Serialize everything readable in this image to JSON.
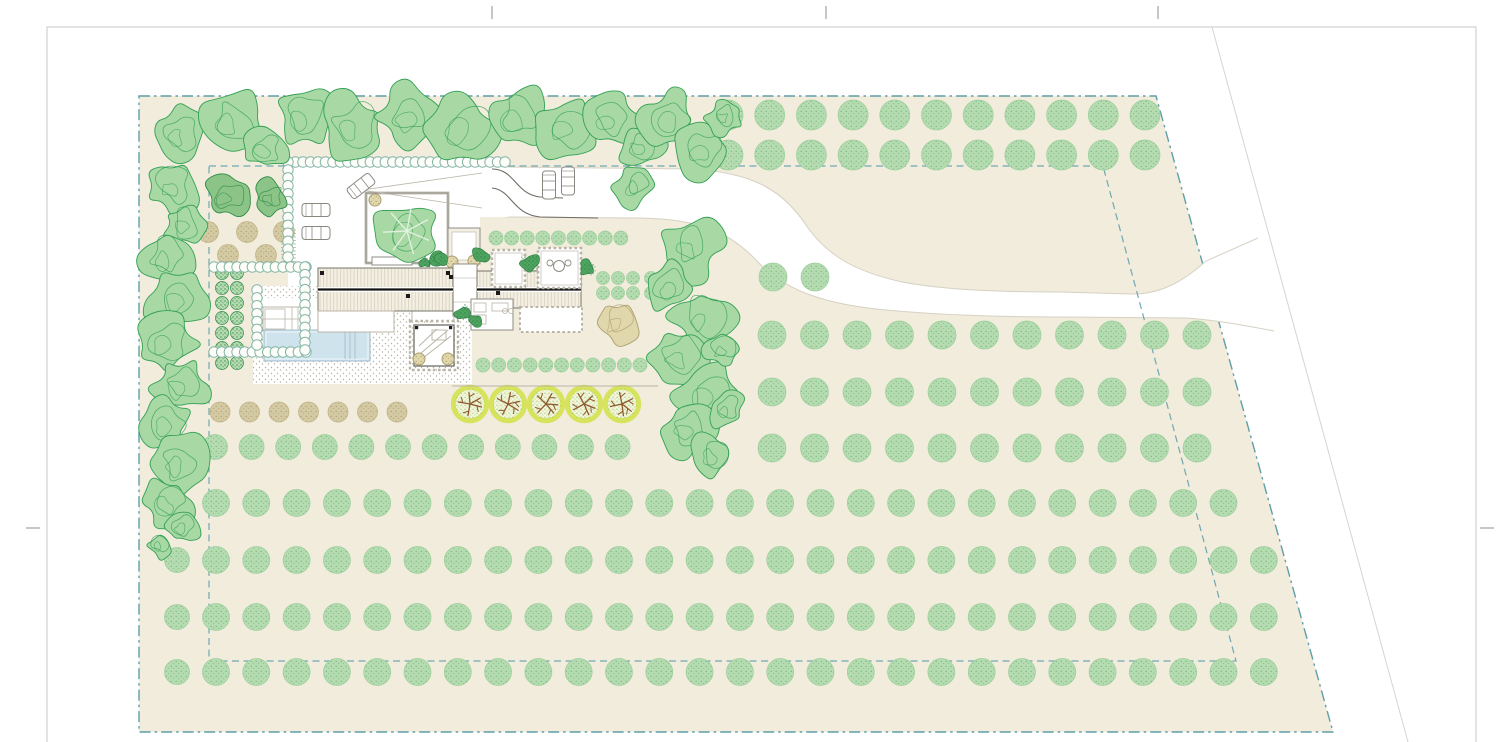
{
  "meta": {
    "drawing": "residential-site-plan",
    "width": 1500,
    "height": 742
  },
  "palette": {
    "paper": "#ffffff",
    "frame": "#c9c9c9",
    "crop": "#8c8c8c",
    "diag_road": "#d4d4d4",
    "site_fill": "#f1ecdc",
    "boundary": "#5f9fa8",
    "inner_boundary": "#6fa8b2",
    "road_edge": "#d6d1c3",
    "compound_fill": "#ffffff",
    "orchard_fill": "#b5dbb0",
    "orchard_stroke": "#9ccf9b",
    "orchard_speck": "#63a96f",
    "tan_fill": "#d3c9a2",
    "tan_stroke": "#c0b186",
    "tan_speck": "#a3905f",
    "hatch_fill": "#a8d8a4",
    "hatch_stroke": "#33a055",
    "dark_fill": "#8cc487",
    "dark_stroke": "#2d8c49",
    "clump_fill": "#4ea45f",
    "clump_stroke": "#2e7d43",
    "chain_stroke": "#84b5a6",
    "chain_fill": "#fdfdf9",
    "yellow_ring": "#d7e35c",
    "yellow_fill": "#f3f5d9",
    "yellow_speck": "#86b86a",
    "branch": "#8f5a2e",
    "olive_fill": "#e0d7ad",
    "olive_stroke": "#ac9e6e",
    "pool_fill": "#cfe3ed",
    "pool_edge": "#a6bccb",
    "roof_fill": "#f3efe3",
    "roof_stripe": "#dcd5c3",
    "roof_edge": "#77746a",
    "ridge": "#141414",
    "wall_light": "#c6c3b9",
    "wall_dark": "#8f8c83",
    "detail": "#b9b4a6",
    "gravel_dot": "#b5b0a2",
    "car_stroke": "#8a877f"
  },
  "page": {
    "frame": [
      47,
      27,
      1429,
      745
    ],
    "crop_top_xs": [
      492,
      826,
      1158
    ],
    "crop_top_y": [
      6,
      19
    ],
    "crop_side_y": 528,
    "crop_left_x": [
      26,
      40
    ],
    "crop_right_x": [
      1480,
      1494
    ],
    "diag_road_line": [
      1212,
      27,
      1408,
      742
    ]
  },
  "site": {
    "outer": [
      [
        139,
        96
      ],
      [
        1156,
        96
      ],
      [
        1333,
        732
      ],
      [
        139,
        732
      ]
    ],
    "inner": [
      [
        209,
        166
      ],
      [
        1103,
        166
      ],
      [
        1236,
        661
      ],
      [
        209,
        661
      ]
    ],
    "outer_dash": "11 4 2.5 4",
    "inner_dash": "7 4.5"
  },
  "road": {
    "outline": "M505,167 L690,169 C755,172 785,192 808,228 C830,258 858,272 902,282 C945,290 1000,292 1060,292 L1130,294 C1162,295 1186,279 1206,261 L1258,238 L1274,331 C1242,325 1216,320 1186,318 L1060,317 C1000,317 940,315 886,310 C830,305 786,292 758,262 C730,232 700,219 640,218 L505,217 Z",
    "upper": "M505,167 L690,169 C755,172 785,192 808,228 C830,258 858,272 902,282 C945,290 1000,292 1060,292 L1130,294 C1162,295 1186,279 1206,261 L1258,238",
    "lower": "M505,217 L640,218 C700,219 730,232 758,262 C786,292 830,305 886,310 C940,315 1000,317 1060,317 L1186,318 C1216,320 1242,325 1274,331"
  },
  "compound": {
    "poly": [
      [
        288,
        161
      ],
      [
        508,
        161
      ],
      [
        508,
        217
      ],
      [
        480,
        217
      ],
      [
        480,
        268
      ],
      [
        370,
        268
      ],
      [
        370,
        290
      ],
      [
        288,
        290
      ]
    ]
  },
  "stair": {
    "rect": [
      281,
      230,
      15,
      32
    ],
    "step": 3.5
  },
  "gravel_terrace": {
    "rect": [
      253,
      286,
      219,
      98
    ],
    "white_zone": [
      258,
      298,
      118,
      38
    ]
  },
  "pergola": {
    "outer": [
      263,
      307,
      39,
      24
    ],
    "inner_left": [
      265,
      309,
      20,
      20
    ],
    "vlines": [
      292,
      298
    ],
    "hline": 319
  },
  "pool": {
    "rect": [
      264,
      330,
      106,
      31
    ],
    "steps": [
      345,
      350,
      355
    ]
  },
  "chairs": {
    "positions": [
      [
        339,
        311
      ],
      [
        348,
        311
      ],
      [
        357,
        311
      ]
    ],
    "w": 7,
    "h": 13
  },
  "pavilion": {
    "patio": [
      412,
      307,
      42,
      16
    ],
    "room": [
      414,
      325,
      40,
      41
    ],
    "olives": [
      [
        419,
        359
      ],
      [
        448,
        359
      ]
    ],
    "squares": [
      [
        415,
        326
      ],
      [
        449,
        326
      ]
    ],
    "diagonals": [
      [
        420,
        354,
        448,
        330
      ],
      [
        423,
        358,
        451,
        336
      ],
      [
        419,
        346,
        437,
        329
      ]
    ],
    "mini_rect": [
      432,
      330,
      14,
      10
    ]
  },
  "courtyard": {
    "rect": [
      366,
      193,
      82,
      70
    ],
    "planter": [
      372,
      257,
      40,
      8
    ],
    "tree": {
      "c": [
        407,
        231
      ],
      "r": 30,
      "seed": 101
    },
    "corner_olive": [
      375,
      200,
      6
    ]
  },
  "vestibule": {
    "rect": [
      448,
      228,
      32,
      36
    ],
    "olives": [
      [
        452,
        262
      ],
      [
        474,
        261
      ]
    ]
  },
  "connector": {
    "rect": [
      453,
      264,
      24,
      52
    ]
  },
  "wings": {
    "left": [
      318,
      268,
      135,
      43
    ],
    "right": [
      477,
      271,
      104,
      37
    ],
    "ridge_y": 289.5,
    "vents": [
      [
        320,
        271
      ],
      [
        446,
        271
      ],
      [
        406,
        294
      ],
      [
        496,
        291
      ],
      [
        449,
        275
      ]
    ]
  },
  "south_rooms": {
    "kitchen": [
      471,
      299,
      42,
      31
    ],
    "fixture_rects": [
      [
        474,
        303,
        12,
        9
      ],
      [
        474,
        315,
        12,
        9
      ],
      [
        492,
        303,
        16,
        8
      ]
    ],
    "fixture_circles": [
      [
        505,
        311
      ],
      [
        511,
        311
      ]
    ],
    "patio": [
      520,
      307,
      62,
      25
    ],
    "left_room": [
      318,
      311,
      76,
      21
    ]
  },
  "north_rooms": {
    "room_a": [
      492,
      250,
      33,
      37
    ],
    "room_b": [
      538,
      248,
      43,
      40
    ],
    "table": {
      "c": [
        559,
        266
      ],
      "r": 5.5,
      "sides": [
        [
          550,
          263
        ],
        [
          568,
          263
        ]
      ]
    }
  },
  "clumps": [
    [
      481,
      256,
      9
    ],
    [
      530,
      263,
      10
    ],
    [
      588,
      268,
      8
    ],
    [
      463,
      313,
      8
    ],
    [
      436,
      258,
      7
    ],
    [
      425,
      262,
      6
    ],
    [
      442,
      260,
      6
    ],
    [
      475,
      321,
      6
    ]
  ],
  "sight_lines": [
    [
      362,
      190,
      482,
      173
    ],
    [
      362,
      190,
      482,
      208
    ]
  ],
  "drive_curves": [
    "M492,169 C515,169 515,194 540,197 L563,198",
    "M492,188 C512,190 512,214 540,217 L598,218"
  ],
  "cars": [
    [
      316,
      210,
      0
    ],
    [
      316,
      233,
      0
    ],
    [
      361,
      186,
      -38
    ],
    [
      549,
      185,
      90
    ],
    [
      568,
      181,
      90
    ]
  ],
  "orchard": {
    "rows": [
      {
        "y": 115,
        "x0": 728,
        "dx": 41.7,
        "n": 11,
        "d": 30
      },
      {
        "y": 155,
        "x0": 728,
        "dx": 41.7,
        "n": 11,
        "d": 30
      },
      {
        "y": 335,
        "x0": 772,
        "dx": 42.5,
        "n": 11,
        "d": 28
      },
      {
        "y": 392,
        "x0": 772,
        "dx": 42.5,
        "n": 11,
        "d": 28
      },
      {
        "y": 448,
        "x0": 772,
        "dx": 42.5,
        "n": 11,
        "d": 28
      },
      {
        "y": 447,
        "x0": 215,
        "dx": 36.6,
        "n": 12,
        "d": 25
      },
      {
        "y": 503,
        "x0": 216,
        "dx": 40.3,
        "n": 26,
        "d": 27
      },
      {
        "y": 560,
        "x0": 216,
        "dx": 40.3,
        "n": 27,
        "d": 27
      },
      {
        "y": 617,
        "x0": 216,
        "dx": 40.3,
        "n": 27,
        "d": 27
      },
      {
        "y": 672,
        "x0": 216,
        "dx": 40.3,
        "n": 27,
        "d": 27
      }
    ],
    "singles": [
      [
        773,
        277,
        28
      ],
      [
        815,
        277,
        28
      ],
      [
        177,
        560,
        25
      ],
      [
        177,
        617,
        25
      ],
      [
        177,
        672,
        25
      ]
    ]
  },
  "tan_row": {
    "y": 412,
    "x0": 220,
    "dx": 29.5,
    "n": 7,
    "d": 20
  },
  "tan_bed": {
    "d": 21,
    "positions": [
      [
        208,
        232
      ],
      [
        247,
        232
      ],
      [
        284,
        232
      ],
      [
        228,
        255
      ],
      [
        266,
        255
      ]
    ]
  },
  "kitchen_garden": {
    "cols": [
      222,
      237
    ],
    "y0": 273,
    "dy": 15,
    "n": 7,
    "d": 13
  },
  "hedge_rows": [
    {
      "y": 238,
      "x0": 496,
      "dx": 15.6,
      "n": 9,
      "d": 14
    },
    {
      "y": 365,
      "x0": 483,
      "dx": 15.7,
      "n": 11,
      "d": 14
    }
  ],
  "hedge_grids": [
    {
      "x0": 603,
      "dx": 15,
      "n": 3,
      "rows": [
        278,
        293
      ],
      "d": 13
    },
    {
      "x0": 651,
      "dx": 15,
      "n": 3,
      "rows": [
        278,
        293
      ],
      "d": 13
    }
  ],
  "chains": [
    [
      288,
      162,
      505,
      162
    ],
    [
      288,
      162,
      288,
      257
    ],
    [
      214,
      267,
      306,
      267
    ],
    [
      214,
      352,
      306,
      352
    ],
    [
      305,
      267,
      305,
      350
    ],
    [
      257,
      290,
      257,
      345
    ]
  ],
  "yellow_trees": {
    "cy": 404,
    "r": 19,
    "xs": [
      470,
      508,
      546,
      584,
      622
    ]
  },
  "terrace_line": [
    452,
    386,
    658,
    386
  ],
  "olive_tree": [
    617,
    323,
    21,
    55
  ],
  "dark_pair": [
    [
      227,
      197,
      21,
      31
    ],
    [
      270,
      197,
      17,
      32
    ]
  ],
  "canopies": [
    [
      178,
      133,
      26,
      1
    ],
    [
      232,
      122,
      30,
      2
    ],
    [
      265,
      150,
      20,
      3
    ],
    [
      305,
      116,
      30,
      4
    ],
    [
      352,
      128,
      33,
      5
    ],
    [
      408,
      117,
      30,
      6
    ],
    [
      462,
      127,
      33,
      7
    ],
    [
      518,
      117,
      30,
      8
    ],
    [
      566,
      129,
      28,
      9
    ],
    [
      610,
      118,
      26,
      10
    ],
    [
      641,
      147,
      22,
      11
    ],
    [
      635,
      186,
      20,
      12
    ],
    [
      670,
      120,
      28,
      13
    ],
    [
      703,
      149,
      26,
      14
    ],
    [
      725,
      117,
      18,
      15
    ],
    [
      172,
      186,
      26,
      16
    ],
    [
      184,
      224,
      20,
      17
    ],
    [
      166,
      257,
      26,
      18
    ],
    [
      178,
      300,
      30,
      19
    ],
    [
      167,
      344,
      28,
      20
    ],
    [
      180,
      387,
      26,
      21
    ],
    [
      166,
      424,
      24,
      22
    ],
    [
      179,
      463,
      28,
      23
    ],
    [
      168,
      503,
      24,
      24
    ],
    [
      182,
      527,
      17,
      25
    ],
    [
      160,
      545,
      13,
      26
    ],
    [
      690,
      247,
      30,
      27
    ],
    [
      670,
      288,
      25,
      28
    ],
    [
      702,
      318,
      30,
      29
    ],
    [
      680,
      357,
      28,
      30
    ],
    [
      706,
      394,
      30,
      31
    ],
    [
      688,
      429,
      25,
      32
    ],
    [
      712,
      455,
      21,
      33
    ],
    [
      726,
      410,
      18,
      34
    ],
    [
      722,
      350,
      17,
      35
    ]
  ]
}
